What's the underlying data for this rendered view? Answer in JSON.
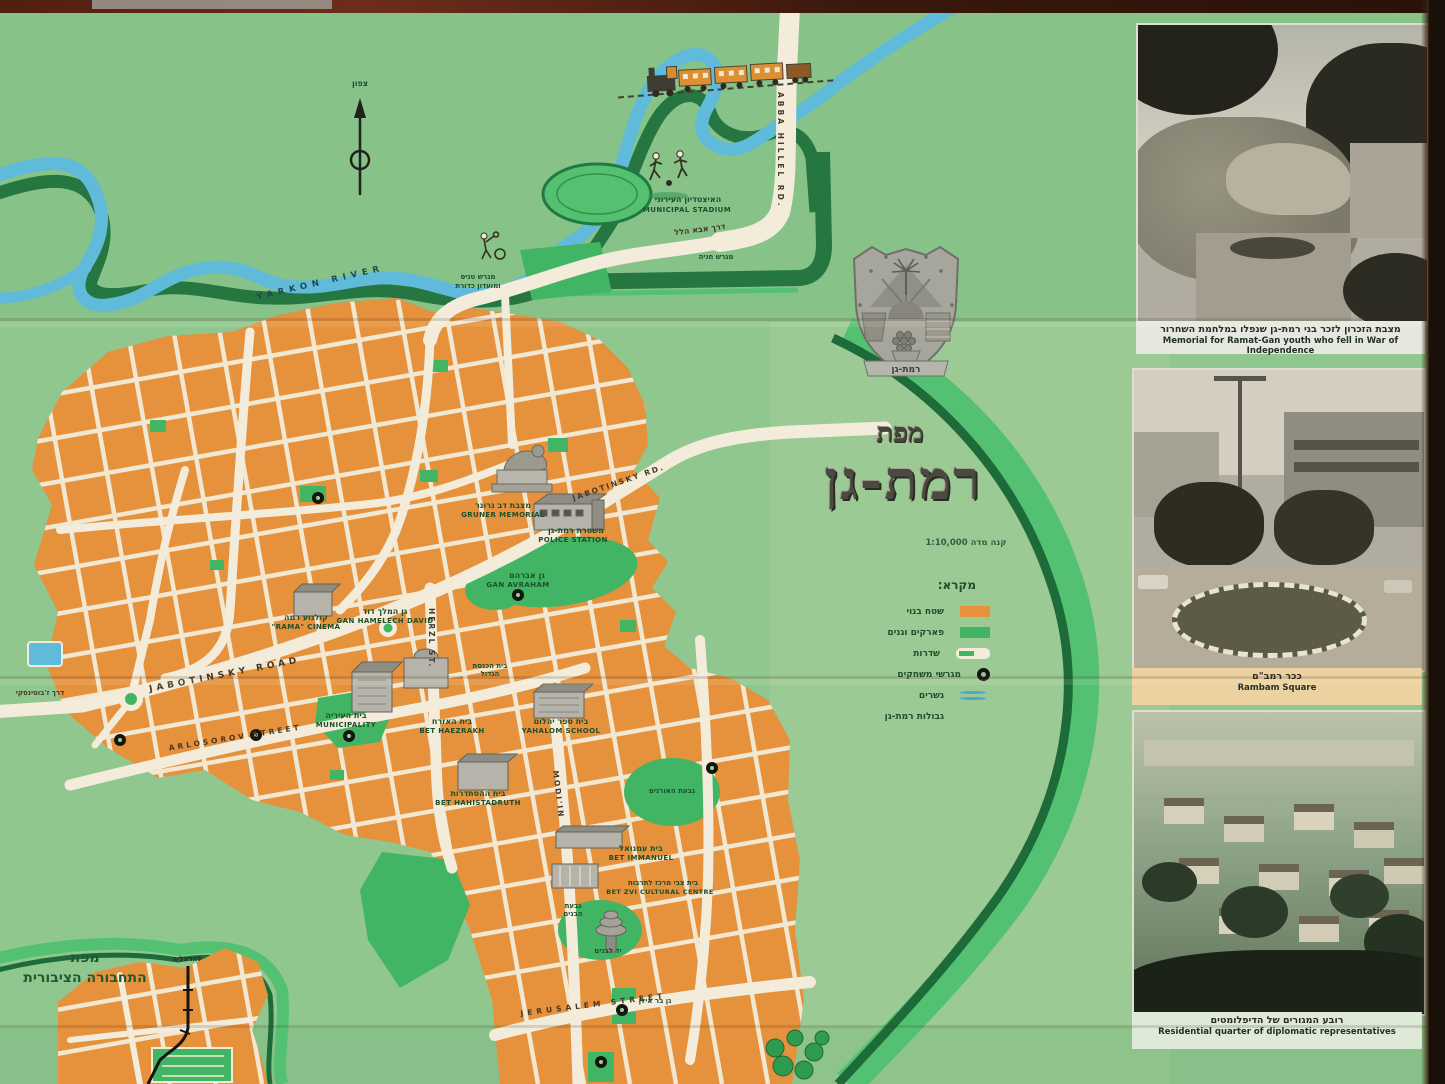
{
  "map": {
    "title": {
      "prefix": "מפת",
      "name": "רמת-גן",
      "scale": "קנה מדה  1:10,000"
    },
    "north_label": "צפון",
    "emblem_label": "רמת-גן",
    "legend": {
      "title": "מקרא:",
      "items": [
        {
          "label": "שטח בנוי",
          "symbol": "built-area"
        },
        {
          "label": "פארקים וגנים",
          "symbol": "parks-gardens"
        },
        {
          "label": "שדרות",
          "symbol": "boulevards"
        },
        {
          "label": "מגרשי משחקים",
          "symbol": "playgrounds"
        },
        {
          "label": "גשרים",
          "symbol": "bridges"
        },
        {
          "label": "גבולות רמת-גן",
          "symbol": "city-boundaries"
        }
      ]
    },
    "labels": {
      "stadium_he": "האיצטדיון העירוני",
      "stadium_en": "MUNICIPAL STADIUM",
      "abba_hillel_en": "ABBA HILLEL RD.",
      "abba_hillel_he": "דרך אבא הלל",
      "parking": "מגרש חניה",
      "tennis_line1": "מגרש טניס",
      "tennis_line2": "ומועדון כדורת",
      "yarkon_en": "YARKON RIVER",
      "jabotinsky_en": "JABOTINSKY ROAD",
      "jabotinsky_short_en": "JABOTINSKY RD.",
      "jabotinsky_he": "דרך ז'בוטינסקי",
      "arlosorov_en": "ARLOSOROV STREET",
      "herzl_en": "HERZL ST.",
      "modiin_en": "MODI'IN",
      "jerusalem_en": "JERUSALEM STREET",
      "gruner_he": "מצבת דב גרונר",
      "gruner_en": "GRUNER MEMORIAL",
      "police_he": "משטרת רמת-גן",
      "police_en": "POLICE STATION",
      "gan_avraham_he": "גן אברהם",
      "gan_avraham_en": "GAN AVRAHAM",
      "cinema_he": "קולנוע רמה",
      "cinema_en": "\"RAMA\" CINEMA",
      "gan_david_he": "גן המלך דוד",
      "gan_david_en": "GAN HAMELECH DAVID",
      "municipality_he": "בית העיריה",
      "municipality_en": "MUNICIPALITY",
      "synagogue_line1": "בית הכנסת",
      "synagogue_line2": "הגדול",
      "yahalom_he": "בית ספר יהלום",
      "yahalom_en": "YAHALOM SCHOOL",
      "haezrach_he": "בית האזרח",
      "haezrach_en": "BET HAEZRAKH",
      "histadrut_he": "בית ההסתדרות",
      "histadrut_en": "BET HAHISTADRUTH",
      "pines_hill": "גבעת האורנים",
      "immanuel_he": "בית עמנואל",
      "immanuel_en": "BET IMMANUEL",
      "bet_zvi_he": "בית צבי מרכז לתרבות",
      "bet_zvi_en": "BET ZVI CULTURAL CENTRE",
      "yad_labanim": "יד לבנים",
      "givat_banim_line1": "גבעת",
      "givat_banim_line2": "הבנים",
      "gan_bar_ilan": "גן בר אילן"
    },
    "inset": {
      "title_line1": "מפת",
      "title_line2": "התחבורה הציבורית",
      "to_herzliya": "להרצליה"
    },
    "colors": {
      "paper_green": "#8fc78f",
      "built_orange": "#e6913c",
      "park_green": "#41b563",
      "river_blue": "#5fbbd9",
      "boundary_dark": "#1c6b38",
      "boundary_bright": "#54c172",
      "road_cream": "#f3ecda"
    }
  },
  "photos": [
    {
      "caption_he": "מצבת הזכרון לזכר בני רמת-גן שנפלו במלחמת השחרור",
      "caption_en": "Memorial for Ramat-Gan youth who fell in War of Independence"
    },
    {
      "caption_he": "ככר רמב\"ם",
      "caption_en": "Rambam Square"
    },
    {
      "caption_he": "רובע המגורים של הדיפלומטים",
      "caption_en": "Residential quarter of diplomatic representatives"
    }
  ]
}
